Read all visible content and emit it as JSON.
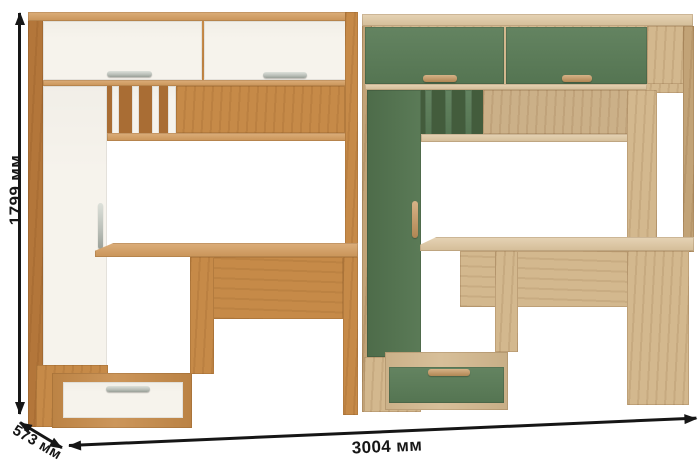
{
  "dimensions": {
    "height": {
      "label": "1799 мм"
    },
    "width": {
      "label": "3004 мм"
    },
    "depth": {
      "label": "573 мм"
    }
  },
  "units": [
    {
      "id": "left-unit",
      "front_finish": "#f6f3ec",
      "wood_finish": "#c68a48",
      "handle_finish": "#b9beb7"
    },
    {
      "id": "right-unit",
      "front_finish": "#5a7c57",
      "wood_finish": "#d3b88e",
      "handle_finish": "#c9995f"
    }
  ],
  "colors": {
    "background": "#ffffff",
    "ink": "#161616",
    "oak": "#c68a48",
    "oak_light": "#d49c5d",
    "oak_dark": "#b3763a",
    "oak_back": "#a96d34",
    "white_front": "#f6f3ec",
    "metal": "#b9beb7",
    "green": "#5a7c57",
    "green_dark": "#547550",
    "green_shadow": "#435c3c",
    "ash": "#d3b88e",
    "ash_light": "#dfc7a0",
    "ash_dark": "#c2a377",
    "ash_back": "#cbb088",
    "wood_handle": "#c9995f"
  }
}
